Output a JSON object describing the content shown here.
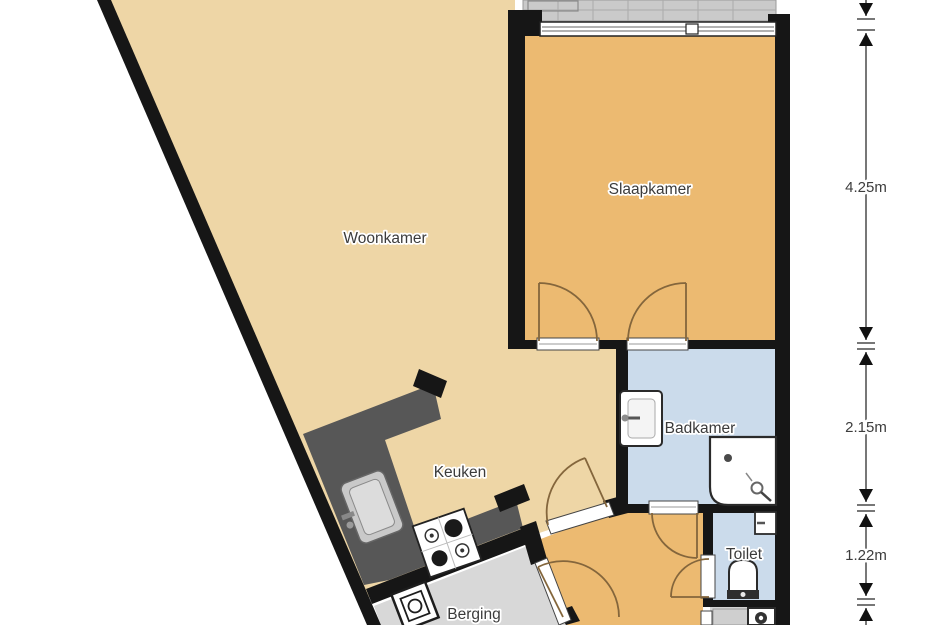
{
  "floorplan": {
    "title": "apartment-floorplan",
    "rooms": [
      {
        "id": "woonkamer",
        "label": "Woonkamer",
        "floor_color": "#eed6a6"
      },
      {
        "id": "slaapkamer",
        "label": "Slaapkamer",
        "floor_color": "#ecba71"
      },
      {
        "id": "keuken",
        "label": "Keuken",
        "floor_color": "#eed6a6"
      },
      {
        "id": "badkamer",
        "label": "Badkamer",
        "floor_color": "#cbdbeb"
      },
      {
        "id": "toilet",
        "label": "Toilet",
        "floor_color": "#cbdbeb"
      },
      {
        "id": "berging",
        "label": "Berging",
        "floor_color": "#d8d8d8"
      },
      {
        "id": "hal",
        "label": "",
        "floor_color": "#ecba71"
      },
      {
        "id": "washok",
        "label": "",
        "floor_color": "#d2d2d2"
      }
    ],
    "dimensions": [
      {
        "label": "4.25m"
      },
      {
        "label": "2.15m"
      },
      {
        "label": "1.22m"
      }
    ],
    "colors": {
      "wall": "#161616",
      "counter": "#575757",
      "door_arc": "#84663c",
      "balcony": "#cacaca",
      "balcony_grid": "#aaaaaa",
      "dimension_line": "#4a4a4a",
      "text": "#3b3b3b"
    },
    "fixtures": [
      "kitchen-sink-icon",
      "stove-icon",
      "washing-machine-icon",
      "bathroom-sink-icon",
      "shower-icon",
      "toilet-bowl-icon",
      "hand-basin-icon",
      "appliance-icon",
      "window-icon",
      "balcony-icon"
    ]
  }
}
